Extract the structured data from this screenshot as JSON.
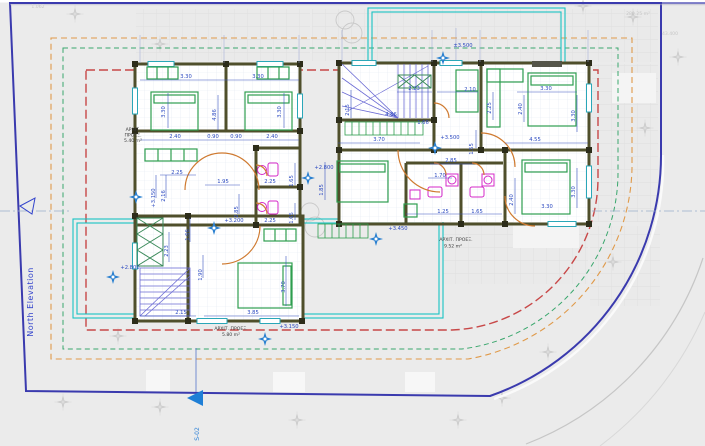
{
  "colors": {
    "boundary": "#3a3aae",
    "setback_red": "#c84848",
    "setback_green": "#3aa76d",
    "setback_orange": "#e09a4a",
    "terrace_cyan": "#17c3c3",
    "walls": "#4f4f2b",
    "furniture_green": "#2f9e4f",
    "fixtures_magenta": "#d428c8",
    "doors_orange": "#cf7a30",
    "dimension_blue": "#2b49c0",
    "stairs_blue": "#6b6bd4",
    "level_marker_blue": "#2a80d0",
    "section_marker_blue": "#1f7fd6"
  },
  "site": {
    "north_elevation": "North Elevation",
    "section": "S-02",
    "level_top": "±3.500",
    "area_right": "280.25 m²",
    "dim_right": "43.400",
    "dim_topleft": "1.062"
  },
  "left_unit": {
    "levels": {
      "hall": "+3.150",
      "landing": "+3.200",
      "rear": "+3.150",
      "terrace": "+2.800",
      "terrace2": "+2.800"
    },
    "areas": {
      "proj1_l1": "ΑΡΧΙΤ.",
      "proj1_l2": "ΠΡΟΕΞ.",
      "proj1_l3": "5.40 m²",
      "proj2_l1": "ΑΡΧΙΤ. ΠΡΟΕΞ.",
      "proj2_l2": "5.80 m²"
    },
    "dims": {
      "top1": "3.30",
      "top2": "3.30",
      "bed1": "3.30",
      "bed2": "3.30",
      "mid": "4.86",
      "row1": "2.40",
      "row2": "0.90",
      "row3": "0.90",
      "row4": "2.40",
      "hall_w": "2.25",
      "hall_h": "2.16",
      "d195": "1.95",
      "d285": "2.85",
      "bath1_w": "2.25",
      "bath1_h": "1.65",
      "bath2_w": "2.25",
      "bath2_h": "1.65",
      "d166": "1.66",
      "shaft": "2.23",
      "d190": "1.90",
      "bed3_h": "3.70",
      "bed3_w": "3.85",
      "stair_w": "2.15"
    }
  },
  "right_unit": {
    "levels": {
      "hall": "+3.500",
      "deck": "+3.450"
    },
    "areas": {
      "proj_l1": "ΑΡΧΙΤ. ΠΡΟΕΞ.",
      "proj_l2": "9.52 m²"
    },
    "dims": {
      "stair_w": "2.23",
      "stair_h": "2.15",
      "d486": "4.86",
      "d210": "2.10",
      "d225": "2.25",
      "d240": "2.40",
      "bed1_w": "3.30",
      "bed1_h": "3.30",
      "d455": "4.55",
      "deck_w": "1.66",
      "d370": "3.70",
      "d155": "1.55",
      "d285": "2.85",
      "d170": "1.70",
      "sofa_h": "1.85",
      "bath1_w": "1.25",
      "bath2_w": "1.65",
      "d240b": "2.40",
      "bed2_w": "3.30",
      "bed2_h": "3.30"
    }
  }
}
